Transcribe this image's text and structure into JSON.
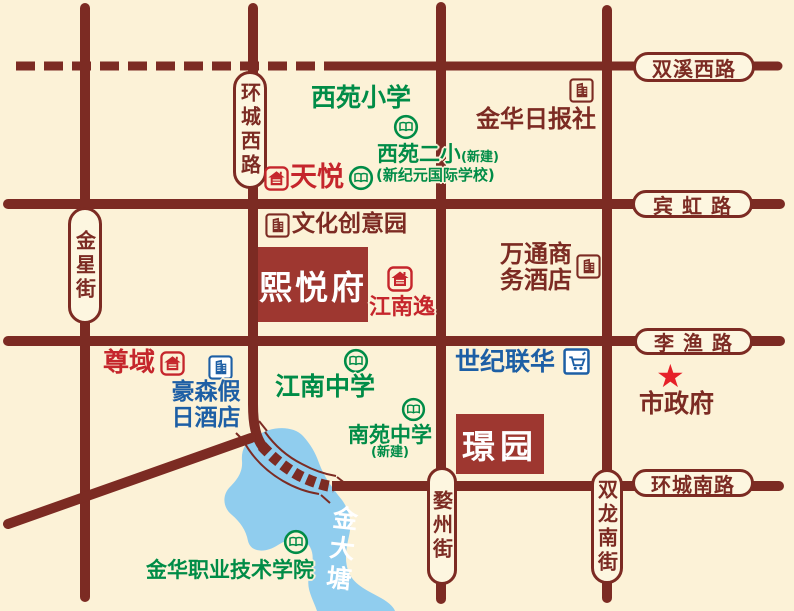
{
  "roads": {
    "shuangxi_west": "双溪西路",
    "binhong": "宾 虹 路",
    "liyu": "李 渔 路",
    "huancheng_south": "环城南路",
    "huancheng_west": "环城西路",
    "jinxing": "金星街",
    "wuzhou": "婺州街",
    "shuanglong": "双龙南街"
  },
  "projects": {
    "xiyuefu": "熙悦府",
    "jingyuan": "璟园"
  },
  "schools": {
    "xiyuan_primary": "西苑小学",
    "xiyuan_second": "西苑二小",
    "xiyuan_second_note": "(新建)",
    "xinjiyuan": "(新纪元国际学校)",
    "jiangnan_middle": "江南中学",
    "nanyuan_middle": "南苑中学",
    "nanyuan_note": "(新建)",
    "polytechnic": "金华职业技术学院"
  },
  "pois": {
    "tianyue": "天悦",
    "zunyu": "尊域",
    "jiangnan_yi": "江南逸",
    "jinhua_daily": "金华日报社",
    "cultural_park": "文化创意园",
    "wantong_line1": "万通商",
    "wantong_line2": "务酒店",
    "haosen_line1": "豪森假",
    "haosen_line2": "日酒店",
    "century_lianhua": "世纪联华",
    "city_government": "市政府"
  },
  "lake": {
    "name": "金大塘"
  },
  "icons": {
    "government_star": "★"
  },
  "colors": {
    "background": "#fcf2d7",
    "road": "#7c2b23",
    "project_box": "#9e3730",
    "school_green": "#008c47",
    "residence_red": "#c5262c",
    "poi_blue": "#1d5fa5",
    "lake_blue": "#90cdee",
    "star_red": "#e62129"
  }
}
